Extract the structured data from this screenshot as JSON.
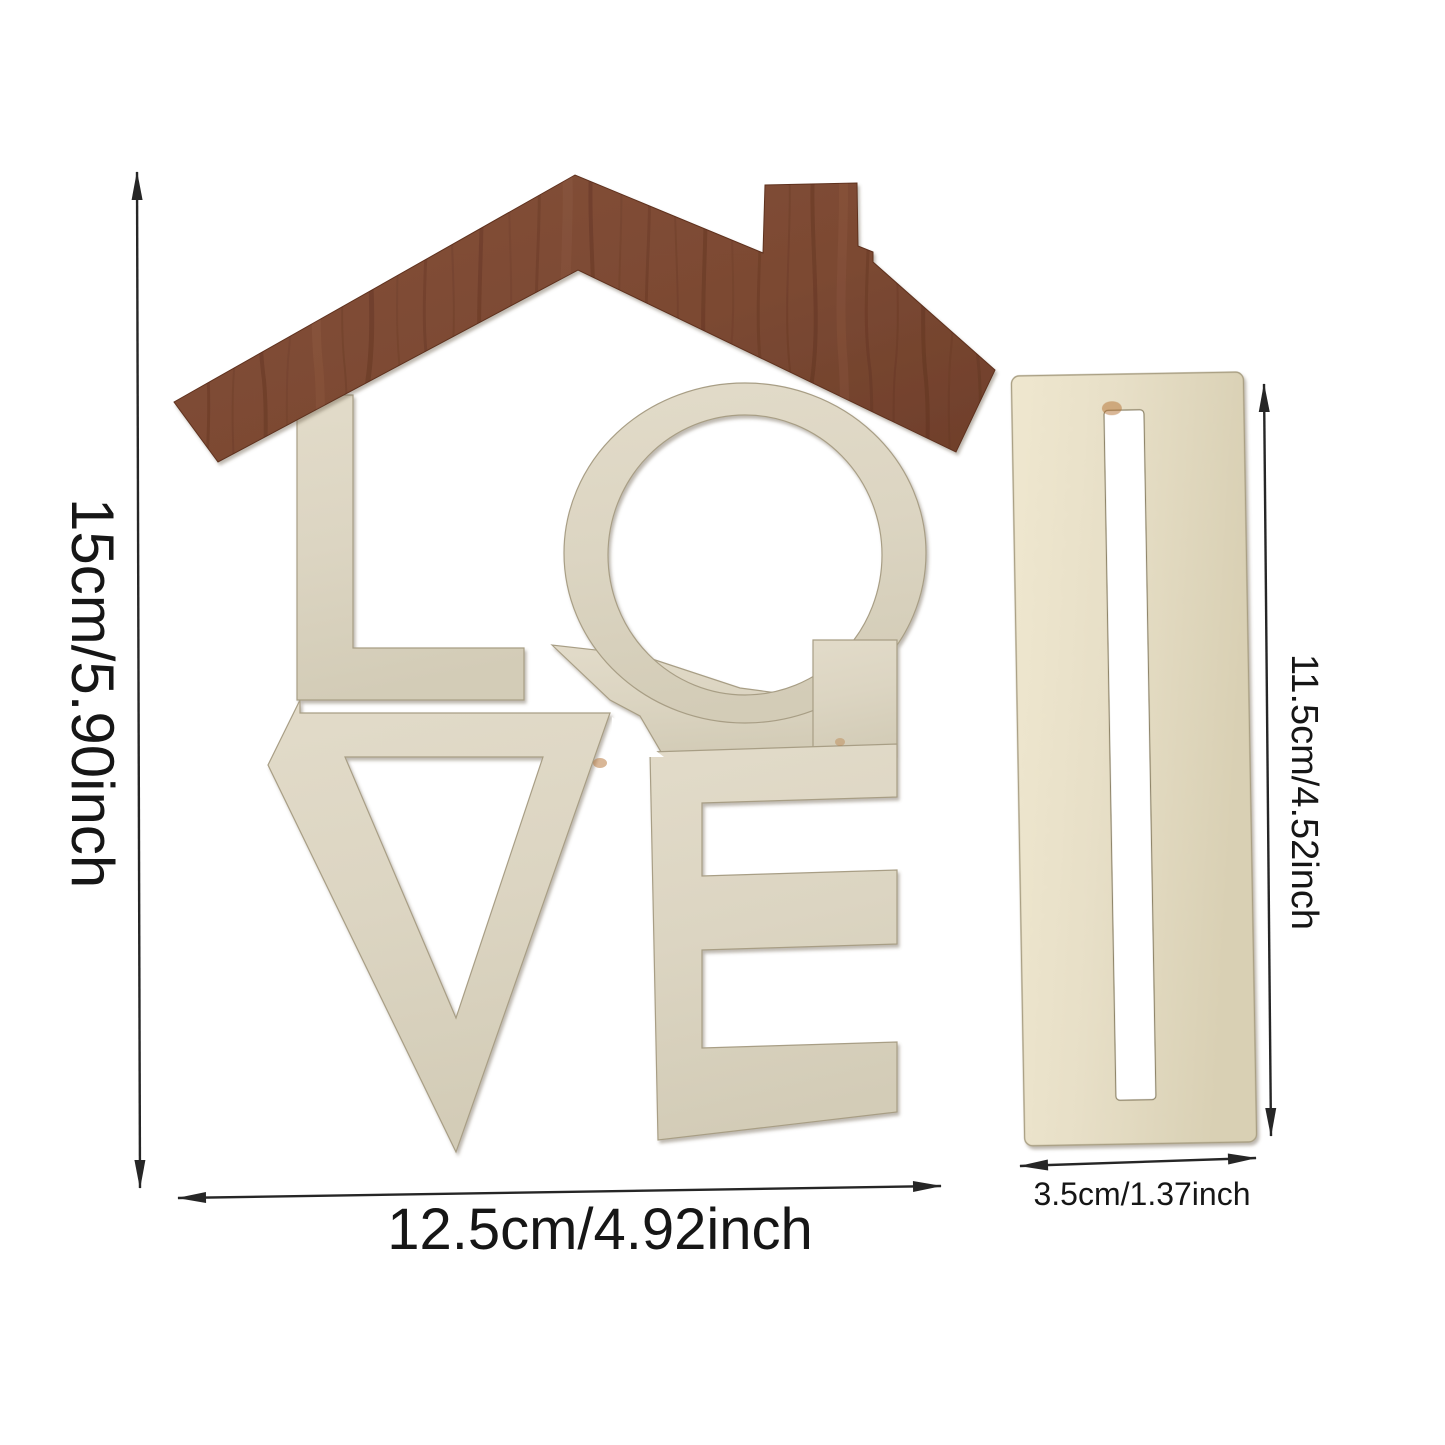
{
  "artwork": {
    "sign_word": "LOVE",
    "letters": [
      "L",
      "O",
      "V",
      "E"
    ]
  },
  "dimensions": {
    "sign_height": "15cm/5.90inch",
    "sign_width": "12.5cm/4.92inch",
    "stand_height": "11.5cm/4.52inch",
    "stand_width": "3.5cm/1.37inch"
  },
  "colors": {
    "background": "#ffffff",
    "roof_wood": "#7d4a33",
    "roof_grain_dark": "#54291a",
    "letters_wood": "#dcd5c2",
    "stand_wood": "#e7dfc7",
    "dimension_line": "#262626"
  }
}
